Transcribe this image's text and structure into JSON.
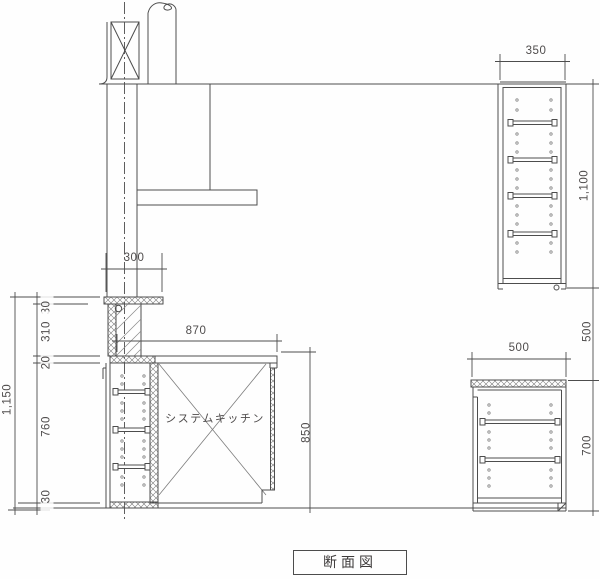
{
  "drawing": {
    "title": "断面図",
    "kitchen_unit_label": "システムキッチン",
    "dims": {
      "bar_counter_depth": "300",
      "upper_cabinet_depth": "350",
      "upper_cabinet_height": "1,100",
      "mid_gap_height": "500",
      "base_cabinet_depth": "500",
      "base_cabinet_height": "700",
      "kitchen_counter_width": "870",
      "kitchen_counter_height": "850",
      "left_total_height": "1,150",
      "bar_top_thickness": "30",
      "bar_to_counter": "310",
      "counter_thickness": "20",
      "left_cabinet_height": "760",
      "base_kick_height": "30"
    },
    "line_color": "#4d4d4d",
    "hatch_color": "#7a7a7a"
  }
}
